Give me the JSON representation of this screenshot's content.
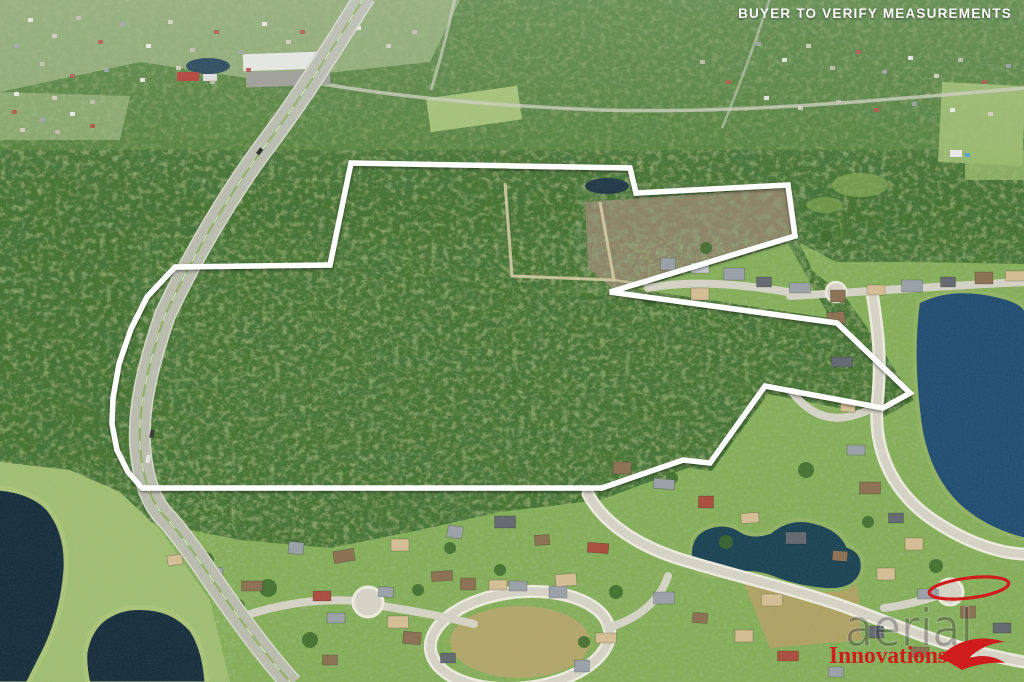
{
  "overlay": {
    "disclaimer": "BUYER TO VERIFY MEASUREMENTS"
  },
  "watermark": {
    "brand": "aerial",
    "sub": "Innovations"
  },
  "palette": {
    "forest": "#436f2d",
    "forest_distant": "#5d8a3f",
    "lawn": "#82ad56",
    "water_dark": "#132a3b",
    "water_lake": "#1d4a70",
    "water_pond": "#174052",
    "road": "#b9bbae",
    "street": "#d5d3c6",
    "street_casing": "#edecdf",
    "cleared": "#8d8266",
    "dirt": "#d6cba4",
    "boundary": "#ffffff",
    "accent_red": "#cf1d1d"
  },
  "boundary": {
    "stroke_width": 5.5,
    "points": [
      [
        351,
        163
      ],
      [
        630,
        168
      ],
      [
        636,
        193
      ],
      [
        788,
        185
      ],
      [
        795,
        236
      ],
      [
        610,
        292
      ],
      [
        837,
        323
      ],
      [
        910,
        393
      ],
      [
        883,
        408
      ],
      [
        765,
        386
      ],
      [
        710,
        463
      ],
      [
        683,
        460
      ],
      [
        602,
        488
      ],
      [
        142,
        488
      ],
      [
        128,
        472
      ],
      [
        117,
        450
      ],
      [
        112,
        424
      ],
      [
        113,
        398
      ],
      [
        119,
        364
      ],
      [
        131,
        329
      ],
      [
        147,
        297
      ],
      [
        175,
        267
      ],
      [
        330,
        265
      ]
    ]
  }
}
